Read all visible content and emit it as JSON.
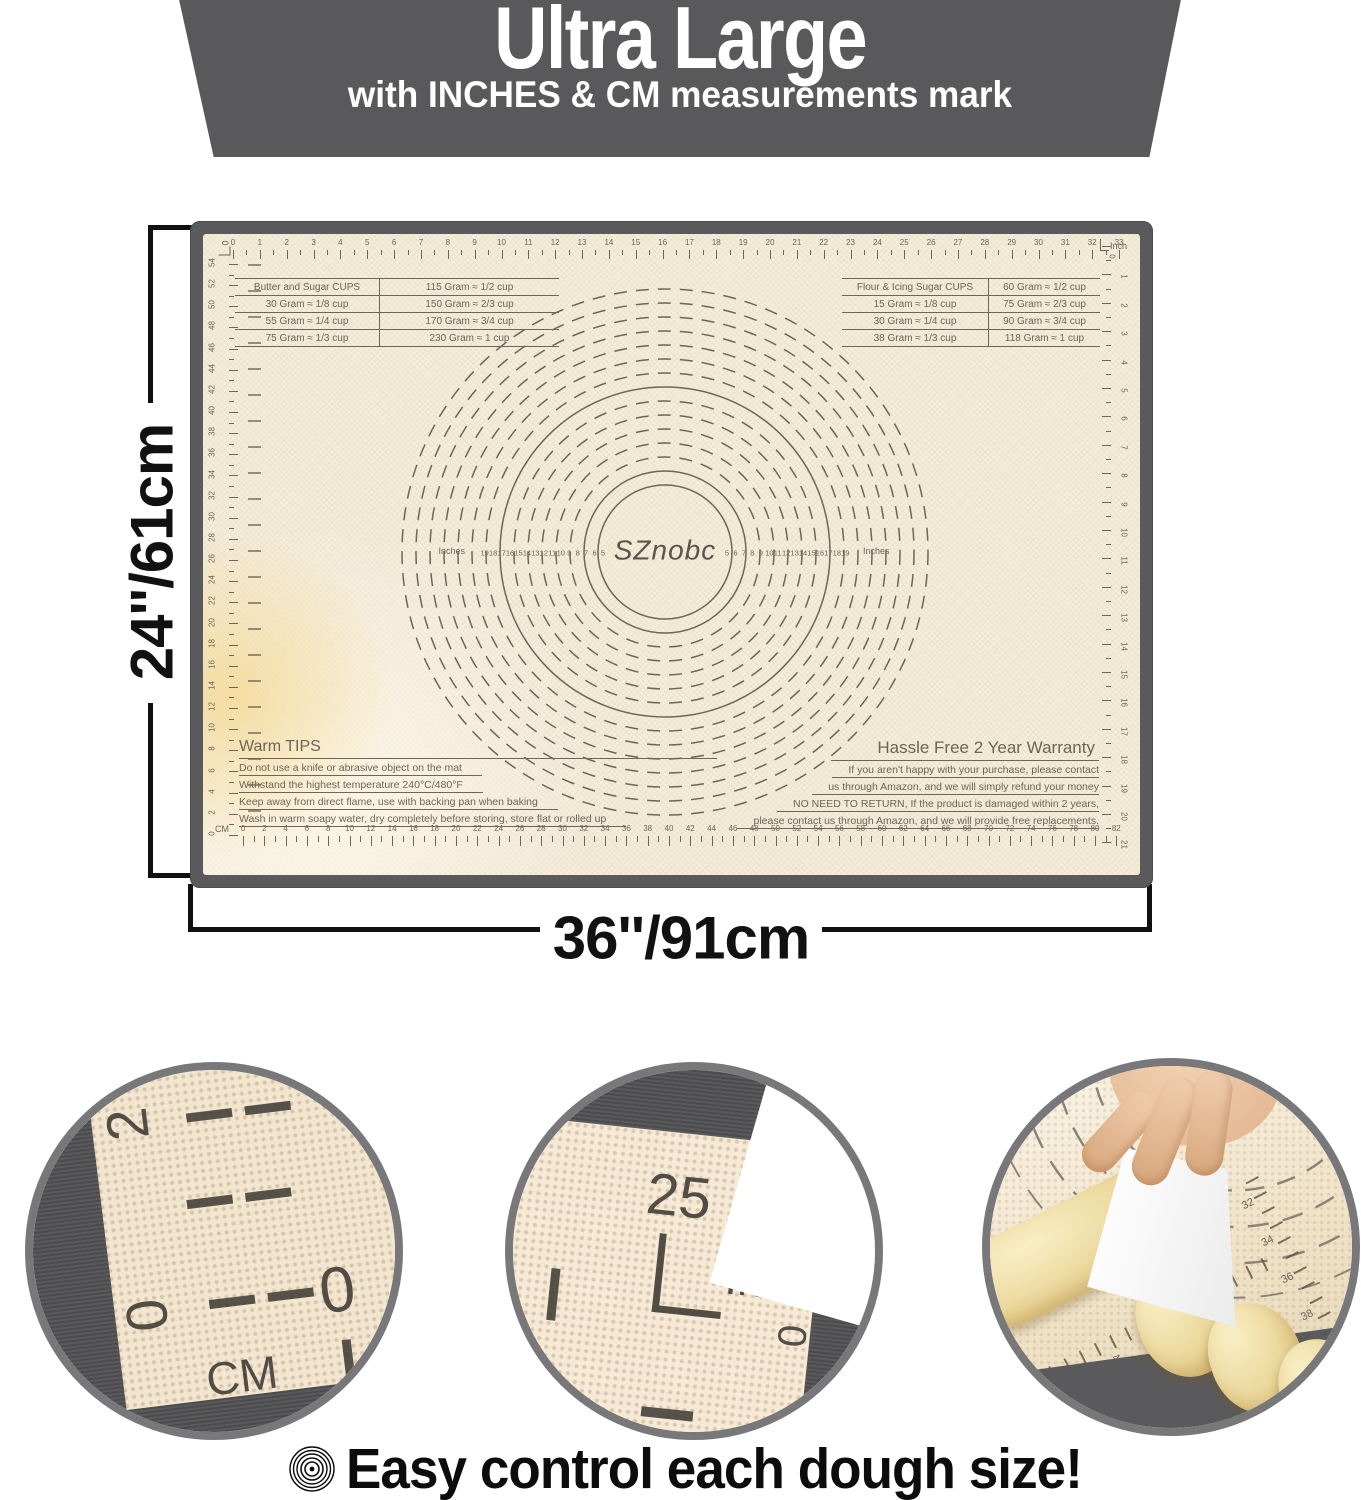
{
  "banner": {
    "title": "Ultra Large",
    "subtitle": "with INCHES & CM measurements mark"
  },
  "dimensions": {
    "height_label": "24''/61cm",
    "width_label": "36''/91cm"
  },
  "mat": {
    "brand": "SZnobc",
    "rulers": {
      "top": {
        "unit": "Inch",
        "numbers": [
          "0",
          "1",
          "2",
          "3",
          "4",
          "5",
          "6",
          "7",
          "8",
          "9",
          "10",
          "11",
          "12",
          "13",
          "14",
          "15",
          "16",
          "17",
          "18",
          "19",
          "20",
          "21",
          "22",
          "23",
          "24",
          "25",
          "26",
          "27",
          "28",
          "29",
          "30",
          "31",
          "32",
          "33"
        ]
      },
      "bottom": {
        "unit": "CM",
        "numbers": [
          "0",
          "2",
          "4",
          "6",
          "8",
          "10",
          "12",
          "14",
          "16",
          "18",
          "20",
          "22",
          "24",
          "26",
          "28",
          "30",
          "32",
          "34",
          "36",
          "38",
          "40",
          "42",
          "44",
          "46",
          "48",
          "50",
          "52",
          "54",
          "56",
          "58",
          "60",
          "62",
          "64",
          "66",
          "68",
          "70",
          "72",
          "74",
          "76",
          "78",
          "80",
          "82"
        ]
      },
      "left": {
        "corner_zero": "0",
        "numbers": [
          "54",
          "52",
          "50",
          "48",
          "46",
          "44",
          "42",
          "40",
          "38",
          "36",
          "34",
          "32",
          "30",
          "28",
          "26",
          "24",
          "22",
          "20",
          "18",
          "16",
          "14",
          "12",
          "10",
          "8",
          "6",
          "4",
          "2",
          "0"
        ]
      },
      "right": {
        "unit": "Inch",
        "corner_zero": "0",
        "numbers": [
          "1",
          "2",
          "3",
          "4",
          "5",
          "6",
          "7",
          "8",
          "9",
          "10",
          "11",
          "12",
          "13",
          "14",
          "15",
          "16",
          "17",
          "18",
          "19",
          "20",
          "21"
        ]
      }
    },
    "center": {
      "caption_left": "Inches",
      "caption_right": "Inches",
      "ring_numbers": [
        "5",
        "6",
        "7",
        "8",
        "9",
        "10",
        "11",
        "12",
        "13",
        "14",
        "15",
        "16",
        "17",
        "18",
        "19"
      ]
    },
    "conversion_tables": {
      "left": {
        "rows": [
          [
            "Butter and Sugar CUPS",
            "115 Gram ≈ 1/2 cup"
          ],
          [
            "30 Gram ≈ 1/8 cup",
            "150 Gram ≈ 2/3 cup"
          ],
          [
            "55 Gram ≈ 1/4 cup",
            "170 Gram ≈ 3/4 cup"
          ],
          [
            "75 Gram ≈ 1/3 cup",
            "230 Gram ≈ 1 cup"
          ]
        ]
      },
      "right": {
        "rows": [
          [
            "Flour & Icing Sugar CUPS",
            "60 Gram ≈ 1/2 cup"
          ],
          [
            "15 Gram ≈ 1/8 cup",
            "75 Gram ≈ 2/3 cup"
          ],
          [
            "30 Gram ≈ 1/4 cup",
            "90 Gram ≈ 3/4 cup"
          ],
          [
            "38 Gram ≈ 1/3 cup",
            "118 Gram ≈ 1 cup"
          ]
        ]
      }
    },
    "warm_tips": {
      "title": "Warm TIPS",
      "lines": [
        "Do not use a knife or abrasive object on the mat",
        "Withstand the highest temperature 240°C/480°F",
        "Keep away from direct flame, use with backing pan when baking",
        "Wash in warm soapy water, dry completely before storing, store flat or rolled up"
      ]
    },
    "warranty": {
      "title": "Hassle Free 2 Year Warranty",
      "lines": [
        "If you aren't happy with your purchase, please contact",
        "us through Amazon,  and we will simply refund your money",
        "NO NEED TO RETURN, If the product is damaged within 2 years,",
        "please contact us through Amazon, and we will provide free replacements."
      ]
    }
  },
  "closeups": {
    "cm_corner": {
      "side_number_2": "2",
      "side_number_0": "0",
      "unit": "CM",
      "zero": "0"
    },
    "inch_corner": {
      "number": "25",
      "unit": "Inch",
      "zero": "0"
    },
    "photo": {
      "bottom_numbers": [
        "2",
        "3",
        "4",
        "5",
        "6"
      ],
      "right_numbers": [
        "32",
        "34",
        "36",
        "38",
        "40",
        "42",
        "44"
      ]
    }
  },
  "footer": {
    "caption": "Easy control each dough size!"
  },
  "colors": {
    "banner_bg": "#59595b",
    "mat_frame": "#5a5a5c",
    "mat_surface": "#f5ecd9",
    "print": "#6e6458",
    "ring": "#78787a",
    "accent_black": "#111111",
    "dough": "#ead699"
  }
}
